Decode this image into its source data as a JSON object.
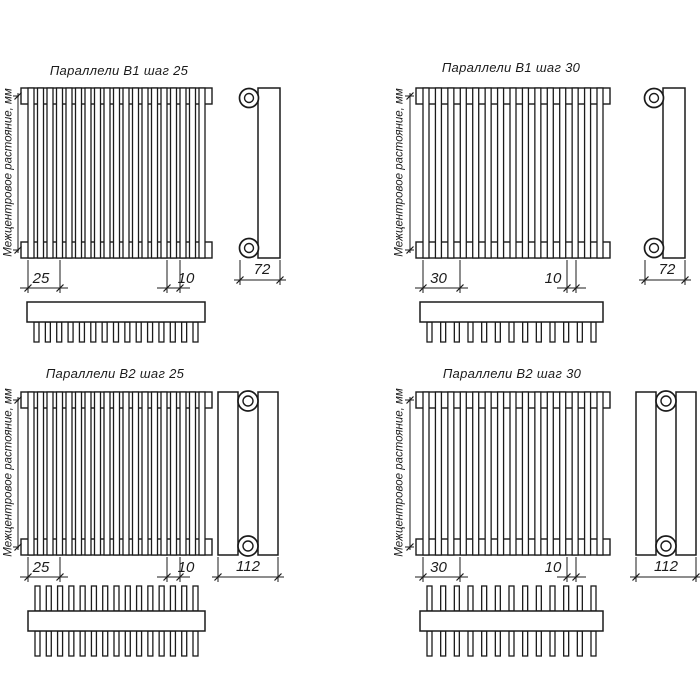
{
  "page": {
    "background": "#ffffff"
  },
  "drawing": {
    "line_color": "#1b1b1b",
    "center_distance_label": "Межцентровое растояние, мм",
    "quadrants": [
      {
        "id": "b1-step-25",
        "title": "Параллели В1 шаг 25",
        "series": "В1",
        "step": "25",
        "slat_width": "10",
        "depth": "72",
        "front_slat_count": 19,
        "top_view_teeth": 15,
        "top_view_rows": 1
      },
      {
        "id": "b1-step-30",
        "title": "Параллели В1 шаг 30",
        "series": "В1",
        "step": "30",
        "slat_width": "10",
        "depth": "72",
        "front_slat_count": 15,
        "top_view_teeth": 13,
        "top_view_rows": 1
      },
      {
        "id": "b2-step-25",
        "title": "Параллели В2 шаг 25",
        "series": "В2",
        "step": "25",
        "slat_width": "10",
        "depth": "112",
        "front_slat_count": 19,
        "top_view_teeth": 15,
        "top_view_rows": 2
      },
      {
        "id": "b2-step-30",
        "title": "Параллели В2 шаг 30",
        "series": "В2",
        "step": "30",
        "slat_width": "10",
        "depth": "112",
        "front_slat_count": 15,
        "top_view_teeth": 13,
        "top_view_rows": 2
      }
    ]
  }
}
